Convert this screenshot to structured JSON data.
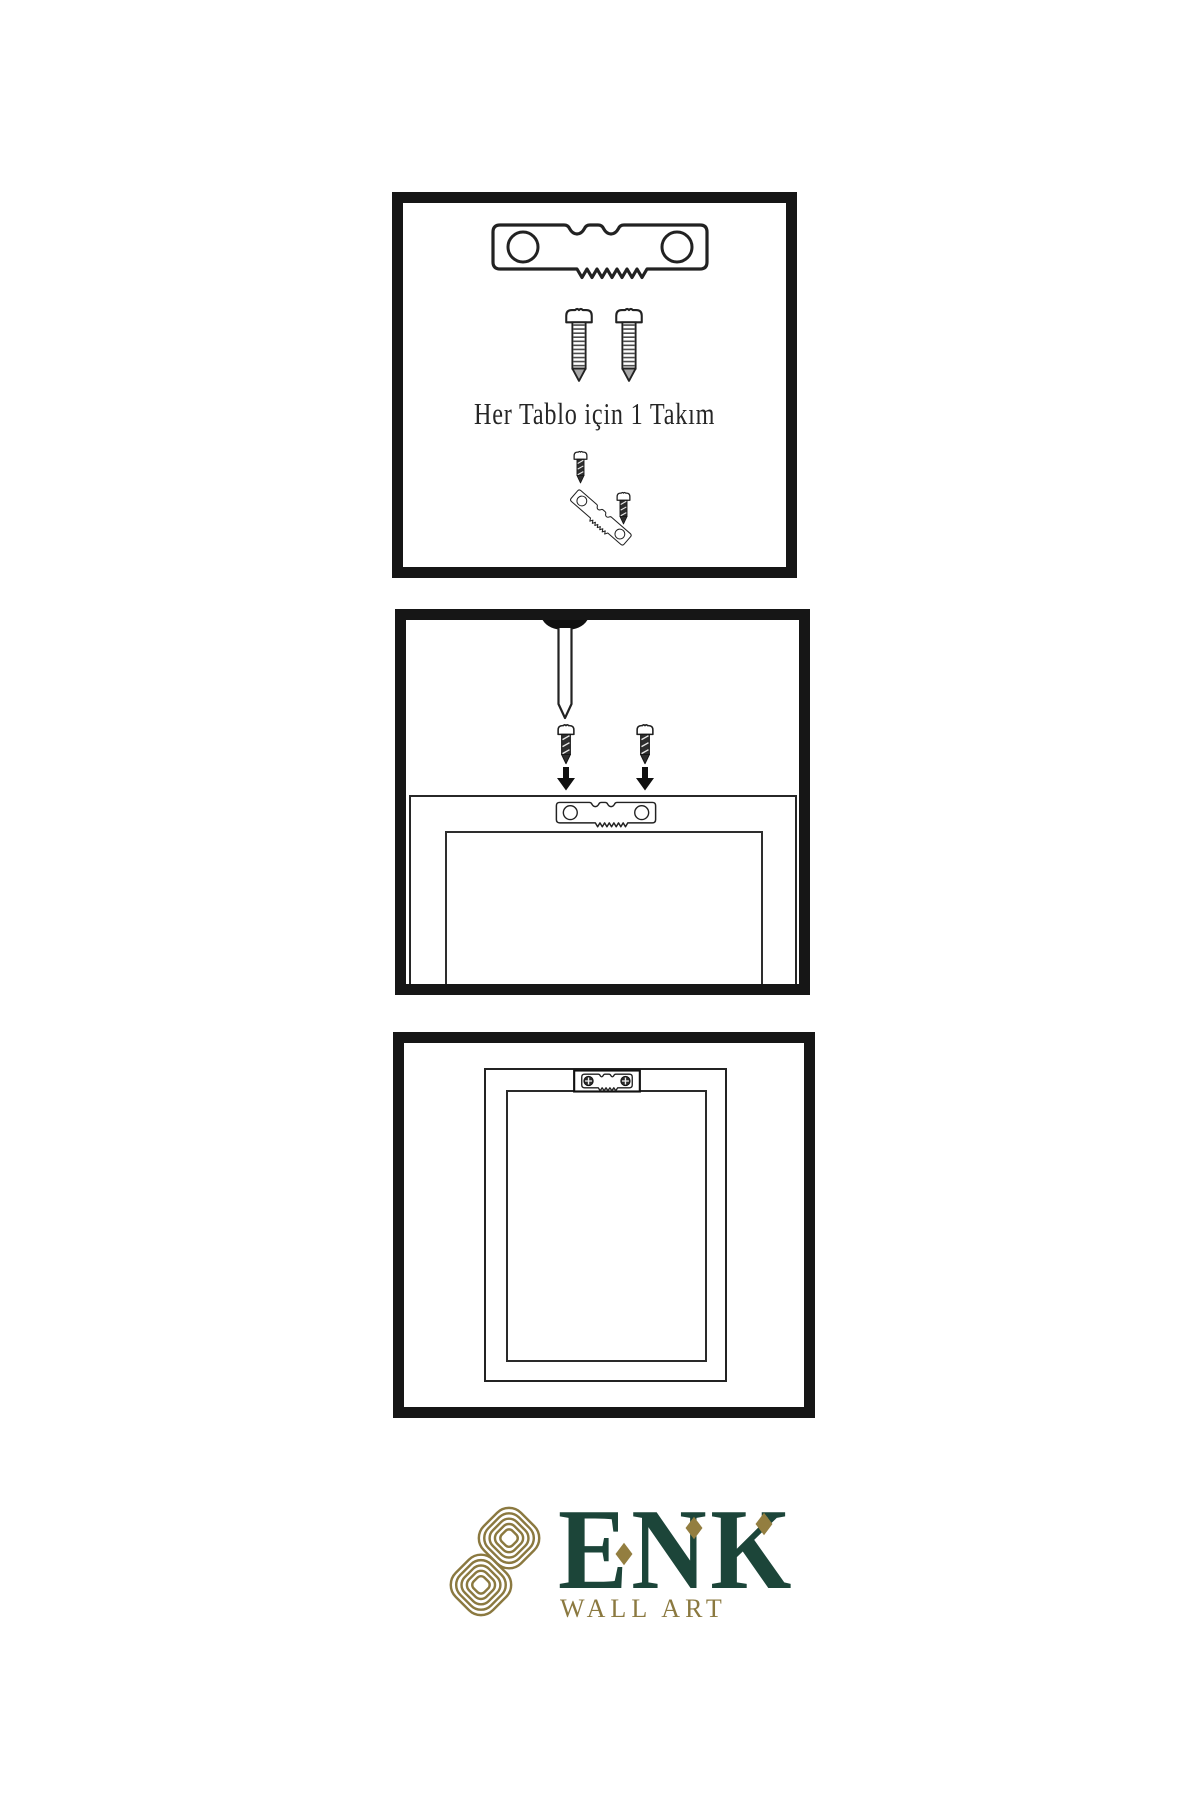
{
  "colors": {
    "ink": "#222222",
    "panel_border": "#161616",
    "screw_dark": "#2e2e2e",
    "brand_green": "#1c4539",
    "brand_gold": "#8b7940"
  },
  "panel_hardware": {
    "caption": "Her Tablo için 1 Takım",
    "icons": [
      "sawtooth-hanger-icon",
      "screw-icon",
      "screw-icon",
      "dark-screw-icon",
      "sawtooth-hanger-angled-icon",
      "dark-screw-icon"
    ]
  },
  "panel_mounting": {
    "icons": [
      "wall-nail-icon",
      "dark-screw-icon",
      "dark-screw-icon",
      "arrow-down-icon",
      "arrow-down-icon",
      "sawtooth-hanger-icon",
      "frame-back-outline",
      "frame-back-inner-outline"
    ]
  },
  "panel_result": {
    "icons": [
      "picture-frame-outline",
      "picture-mat-outline",
      "hanger-plate-icon"
    ]
  },
  "brand": {
    "name": "ENK",
    "tagline": "WALL ART",
    "emblem": "interlocked-knot-icon"
  }
}
